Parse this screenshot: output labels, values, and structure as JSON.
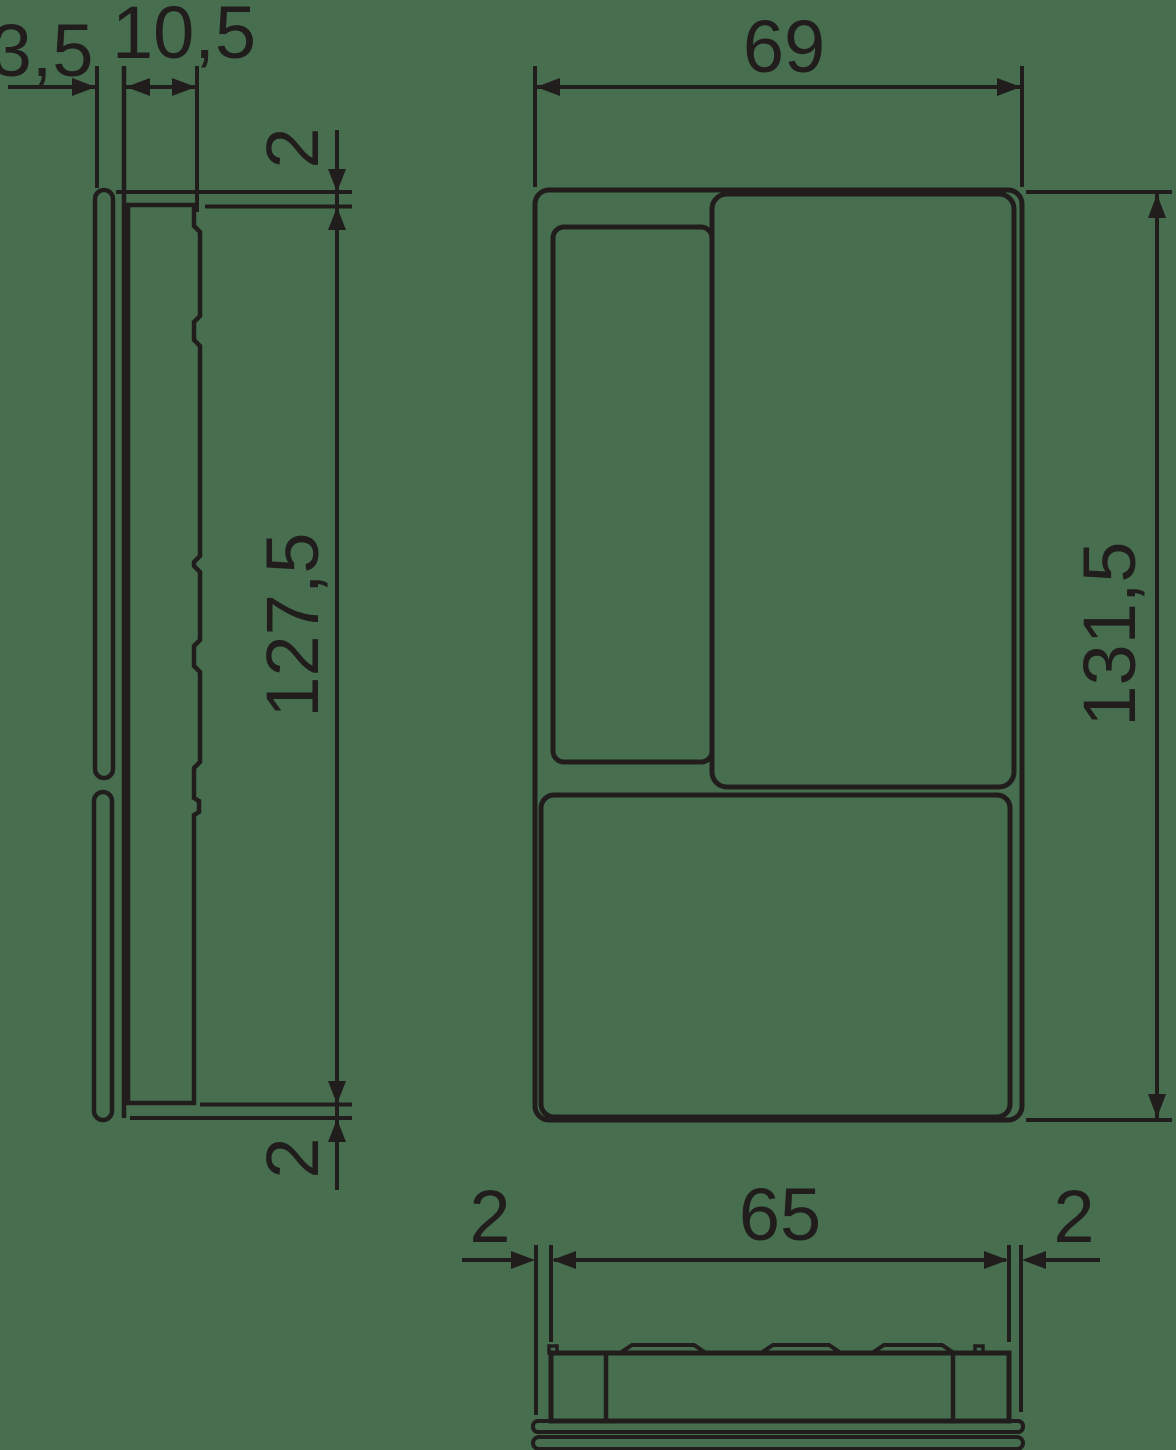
{
  "colors": {
    "background": "#486e50",
    "line": "#201d1c"
  },
  "dimensions": {
    "side": {
      "plate_depth": "3,5",
      "body_depth": "10,5",
      "top_inset": "2",
      "body_height": "127,5",
      "bottom_inset": "2"
    },
    "front": {
      "width": "69",
      "height": "131,5"
    },
    "bottom": {
      "left_inset": "2",
      "body_width": "65",
      "right_inset": "2"
    }
  }
}
